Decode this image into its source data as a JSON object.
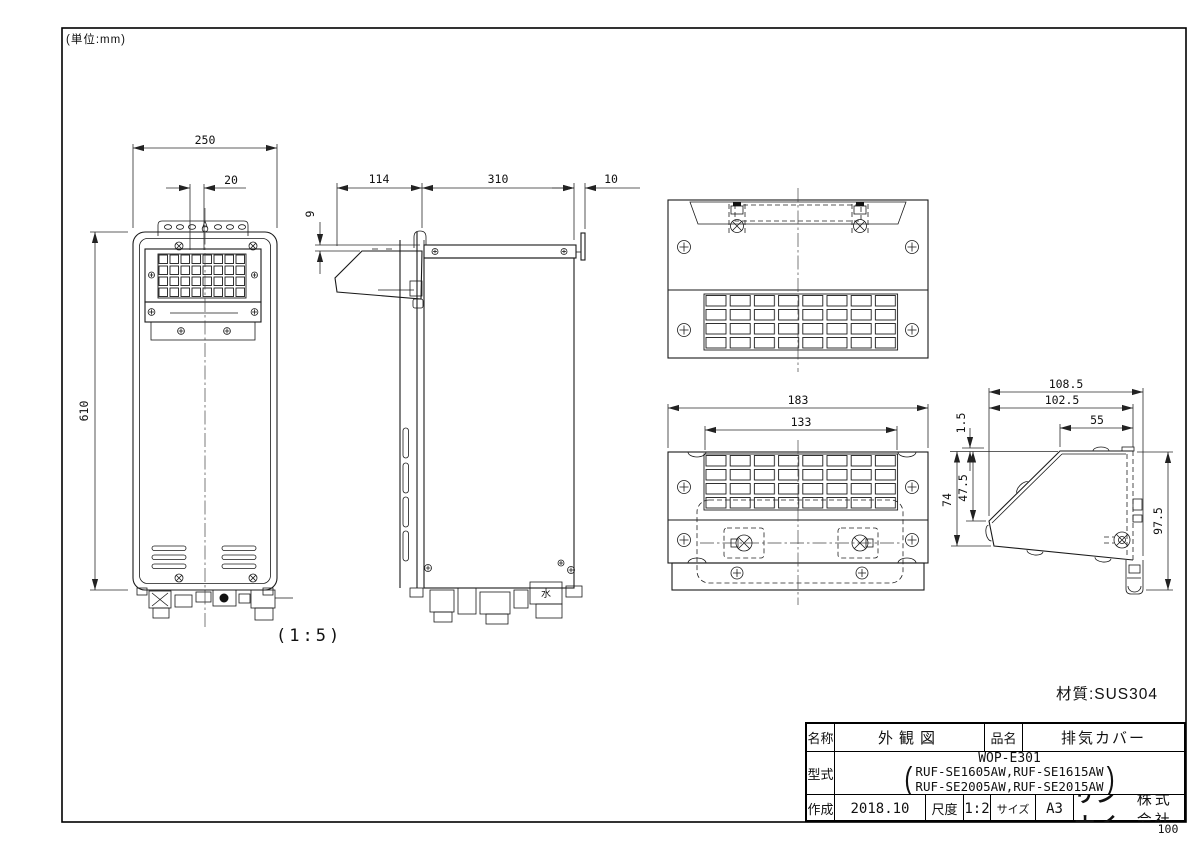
{
  "notes": {
    "unit": "(単位:mm)",
    "view_scale": "(1:5)",
    "material": "材質:SUS304",
    "page_number": "100",
    "water_mark": "水"
  },
  "dims": {
    "front_width": "250",
    "front_offset": "20",
    "front_height": "610",
    "side_cover_depth": "114",
    "side_body_depth": "310",
    "side_rear_gap": "10",
    "side_top_gap": "9",
    "bottom_width": "183",
    "bottom_grille_width": "133",
    "detail_total_depth": "108.5",
    "detail_body_depth": "102.5",
    "detail_top_flat": "55",
    "detail_lip": "1.5",
    "detail_front_height": "47.5",
    "detail_left_height": "74",
    "detail_rear_height": "97.5"
  },
  "title_block": {
    "name_label": "名称",
    "name_value": "外観図",
    "item_label": "品名",
    "item_value": "排気カバー",
    "model_label": "型式",
    "model_line1": "WOP-E301",
    "model_line2": "RUF-SE1605AW,RUF-SE1615AW",
    "model_line3": "RUF-SE2005AW,RUF-SE2015AW",
    "created_label": "作成",
    "created_value": "2018.10",
    "scale_label": "尺度",
    "scale_value": "1:2",
    "size_label": "サイズ",
    "size_value": "A3",
    "company_brand": "リンナイ",
    "company_suffix": "株式会社"
  }
}
